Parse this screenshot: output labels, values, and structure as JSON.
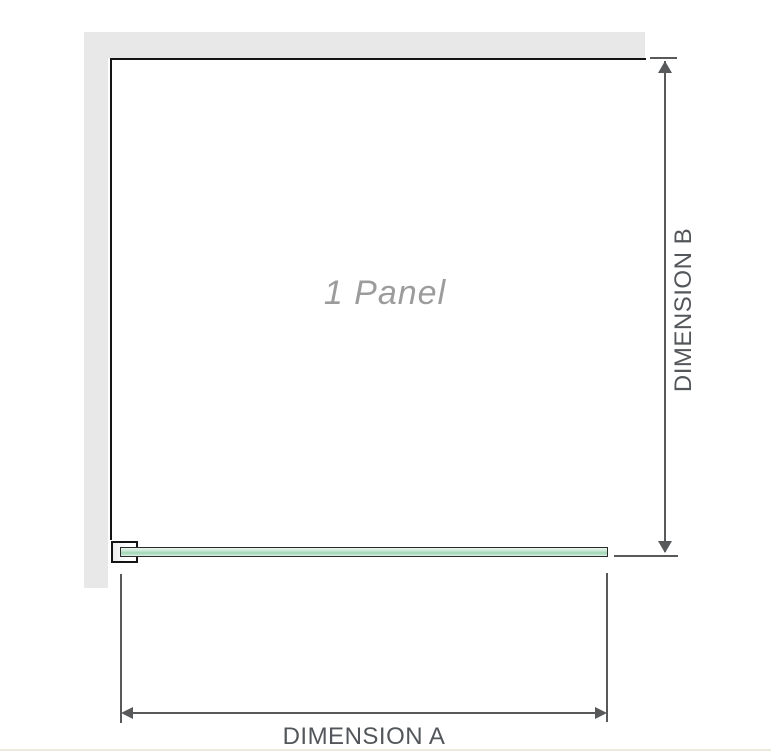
{
  "diagram": {
    "panel_label": "1 Panel",
    "dimension_a": {
      "label": "DIMENSION A"
    },
    "dimension_b": {
      "label": "DIMENSION B"
    }
  },
  "colors": {
    "wall_fill": "#e8e8e8",
    "panel_outline": "#141414",
    "glass_green_mid": "#9fd6b4",
    "glass_green_light": "#e6f5eb",
    "dimension_line": "#58595b",
    "dimension_text": "#53565a",
    "panel_label_text": "#9c9c9c",
    "bottom_rule": "#eceadf"
  }
}
